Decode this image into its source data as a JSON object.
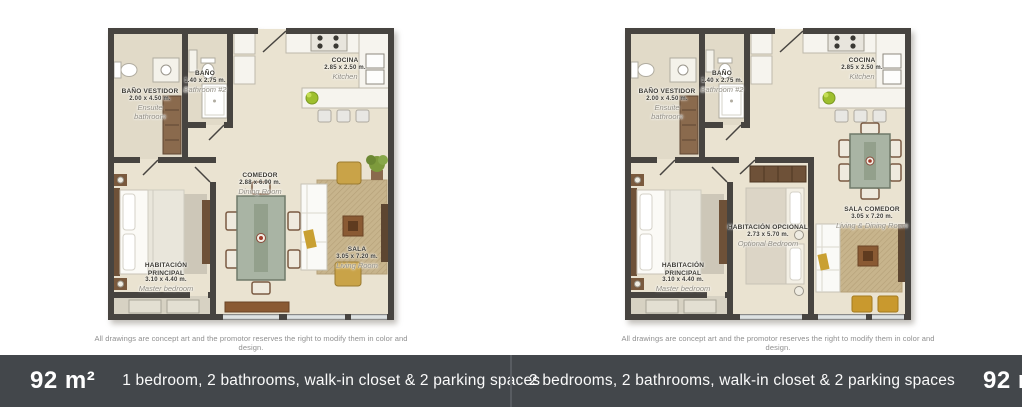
{
  "plans": [
    {
      "title": "1-bedroom unit floor plan",
      "disclaimer": "All drawings are concept art and the promotor reserves the right to modify them in color and design.",
      "rooms": {
        "ensuite": {
          "name_es": "BAÑO VESTIDOR",
          "dims": "2.00 x 4.50 m.",
          "name_en": "Ensuite bathroom"
        },
        "bathroom2": {
          "name_es": "BAÑO",
          "dims": "1.40 x 2.75 m.",
          "name_en": "Bathroom #2"
        },
        "kitchen": {
          "name_es": "COCINA",
          "dims": "2.85 x 2.50 m.",
          "name_en": "Kitchen"
        },
        "dining": {
          "name_es": "COMEDOR",
          "dims": "2.88 x 6.90 m.",
          "name_en": "Dining Room"
        },
        "master": {
          "name_es": "HABITACIÓN PRINCIPAL",
          "dims": "3.10 x 4.40 m.",
          "name_en": "Master bedroom"
        },
        "living": {
          "name_es": "SALA",
          "dims": "3.05 x 7.20 m.",
          "name_en": "Living Room"
        }
      },
      "footer": {
        "area": "92 m²",
        "description": "1 bedroom, 2 bathrooms, walk-in closet & 2 parking spaces"
      }
    },
    {
      "title": "2-bedroom unit floor plan",
      "disclaimer": "All drawings are concept art and the promotor reserves the right to modify them in color and design.",
      "rooms": {
        "ensuite": {
          "name_es": "BAÑO VESTIDOR",
          "dims": "2.00 x 4.50 m.",
          "name_en": "Ensuite bathroom"
        },
        "bathroom2": {
          "name_es": "BAÑO",
          "dims": "1.40 x 2.75 m.",
          "name_en": "Bathroom #2"
        },
        "kitchen": {
          "name_es": "COCINA",
          "dims": "2.85 x 2.50 m.",
          "name_en": "Kitchen"
        },
        "master": {
          "name_es": "HABITACIÓN PRINCIPAL",
          "dims": "3.10 x 4.40 m.",
          "name_en": "Master bedroom"
        },
        "optional": {
          "name_es": "HABITACIÓN OPCIONAL",
          "dims": "2.73 x 5.70 m.",
          "name_en": "Optional Bedroom"
        },
        "living_dining": {
          "name_es": "SALA COMEDOR",
          "dims": "3.05 x 7.20 m.",
          "name_en": "Living & Dining Room"
        }
      },
      "footer": {
        "area": "92 m²",
        "description": "2 bedrooms, 2 bathrooms, walk-in closet & 2 parking spaces"
      }
    }
  ],
  "colors": {
    "footer_background": "#43474b",
    "wall": "#474440",
    "floor": "#eae3d1",
    "rug_tan": "#c7b48c",
    "accent_gold": "#c9a348",
    "table_sage": "#a9b4a4",
    "wood_brown": "#8a5a33"
  }
}
